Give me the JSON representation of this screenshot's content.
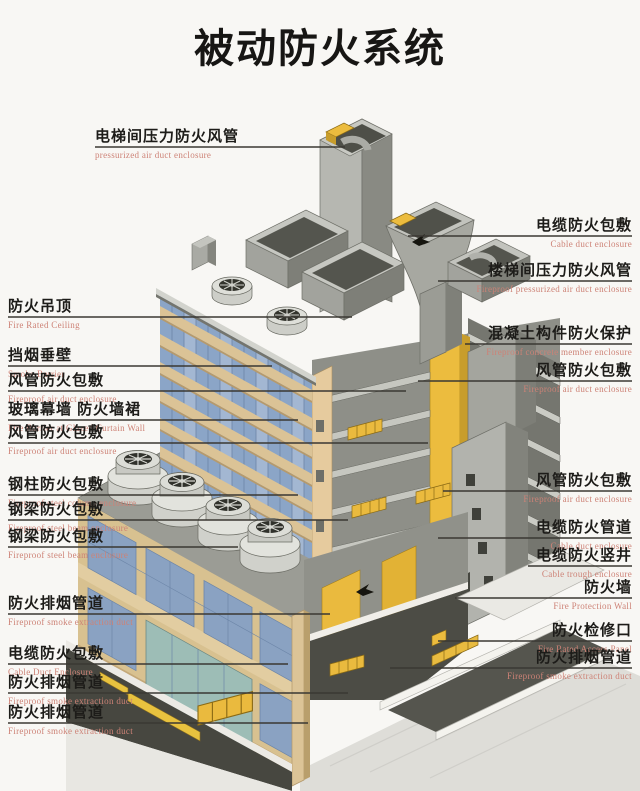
{
  "title": "被动防火系统",
  "diagram": {
    "type": "isometric-building-cutaway",
    "callouts_left": [
      {
        "zh": "电梯间压力防火风管",
        "en": "pressurized air duct enclosure"
      },
      {
        "zh": "防火吊顶",
        "en": "Fire Rated Ceiling"
      },
      {
        "zh": "挡烟垂壁",
        "en": "Smoke Barrier"
      },
      {
        "zh": "风管防火包敷",
        "en": "Fireproof air duct enclosure"
      },
      {
        "zh": "玻璃幕墙 防火墙裙",
        "en": "Fire Barrier at Glazed Curtain Wall"
      },
      {
        "zh": "风管防火包敷",
        "en": "Fireproof air duct enclosure"
      },
      {
        "zh": "钢柱防火包敷",
        "en": "Fireproof steel column enclosure"
      },
      {
        "zh": "钢梁防火包敷",
        "en": "Fireproof steel beam enclosure"
      },
      {
        "zh": "钢梁防火包敷",
        "en": "Fireproof steel beam enclosure"
      },
      {
        "zh": "防火排烟管道",
        "en": "Fireproof smoke extraction duct"
      },
      {
        "zh": "电缆防火包敷",
        "en": "Cable Duct Enclosure"
      },
      {
        "zh": "防火排烟管道",
        "en": "Fireproof smoke extraction duct"
      },
      {
        "zh": "防火排烟管道",
        "en": "Fireproof smoke extraction duct"
      }
    ],
    "callouts_right": [
      {
        "zh": "电缆防火包敷",
        "en": "Cable duct enclosure"
      },
      {
        "zh": "楼梯间压力防火风管",
        "en": "Fireproof pressurized air duct enclosure"
      },
      {
        "zh": "混凝土构件防火保护",
        "en": "Fireproof concrete member enclosure"
      },
      {
        "zh": "风管防火包敷",
        "en": "Fireproof air duct enclosure"
      },
      {
        "zh": "风管防火包敷",
        "en": "Fireproof air duct enclosure"
      },
      {
        "zh": "电缆防火管道",
        "en": "Cable duct enclosure"
      },
      {
        "zh": "电缆防火竖井",
        "en": "Cable trough enclosure"
      },
      {
        "zh": "防火墙",
        "en": "Fire Protection Wall"
      },
      {
        "zh": "防火检修口",
        "en": "Fire Rated Access Panel"
      },
      {
        "zh": "防火排烟管道",
        "en": "Fireproof smoke extraction duct"
      }
    ]
  },
  "colors": {
    "background": "#f8f7f4",
    "title_text": "#171614",
    "label_zh": "#1d1c19",
    "label_en": "#cd8276",
    "leader_line": "#3a3833",
    "fireproof_yellow": "#eaba3e",
    "glass_blue": "#8ba5c7",
    "spandrel_tan": "#dbc396",
    "structure_gray": "#9b9c95",
    "ramp_dark": "#4c4c45"
  }
}
